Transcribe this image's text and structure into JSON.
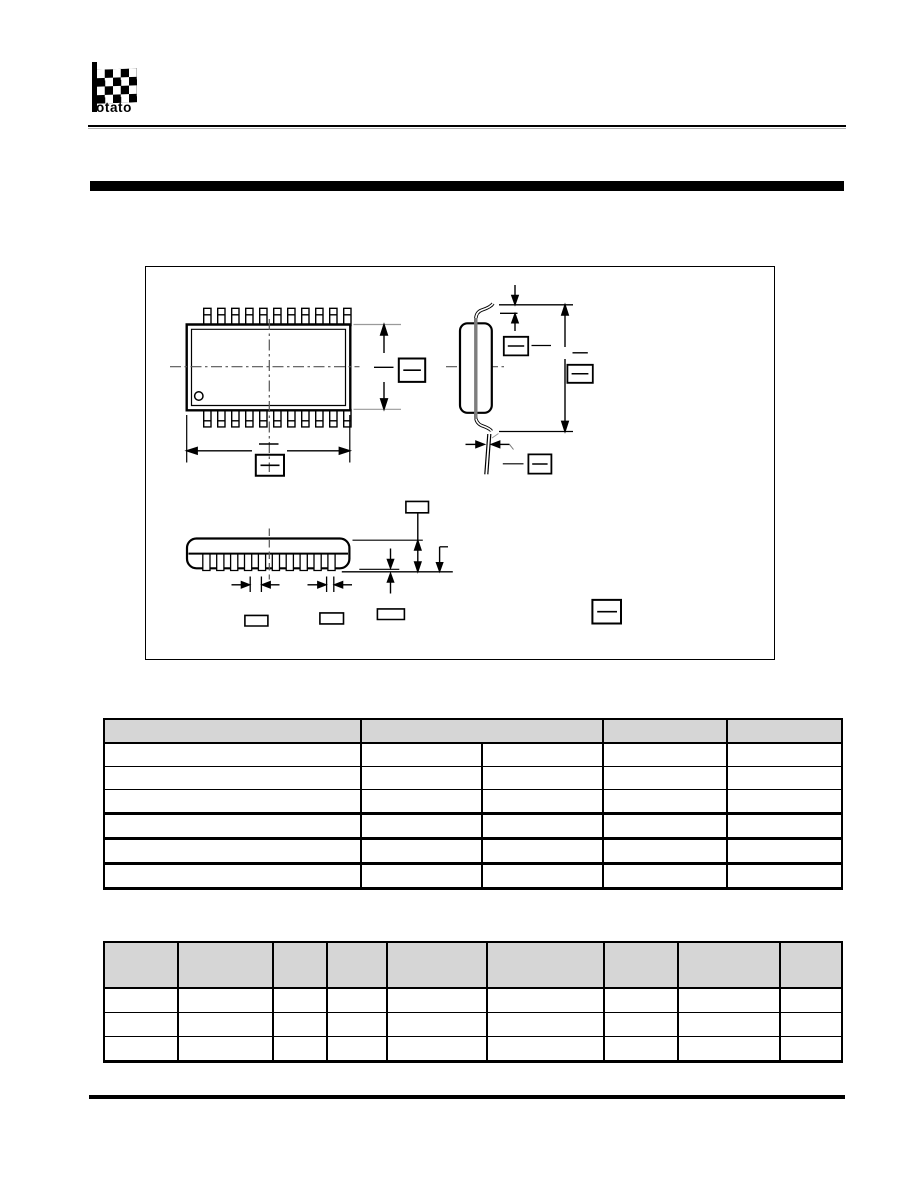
{
  "logo": {
    "brand_suffix": "otato",
    "flag_icon": "checkered-flag",
    "color": "#000000"
  },
  "rules": {
    "color": "#000000",
    "shadow_color": "#b3b3b3"
  },
  "section_bar": {
    "color": "#000000"
  },
  "drawing": {
    "description": "IC package outline drawing (SSOP type): top view, end view and side view with blank dimension callout boxes",
    "views": [
      "top-view",
      "end-view",
      "side-view"
    ],
    "pins_per_side": 11,
    "callout_boxes_with_divider": 6,
    "callout_boxes_plain": 4,
    "colors": {
      "line": "#000000",
      "centerline": "#555555",
      "lead_frame_section": "#7d7d7d",
      "extension_line": "#9a9a9a"
    }
  },
  "table1": {
    "header_fill": "#d6d6d6",
    "header_cells": [
      "",
      "",
      "",
      ""
    ],
    "rows": [
      [
        "",
        "",
        "",
        "",
        ""
      ],
      [
        "",
        "",
        "",
        "",
        ""
      ],
      [
        "",
        "",
        "",
        "",
        ""
      ],
      [
        "",
        "",
        "",
        "",
        ""
      ],
      [
        "",
        "",
        "",
        "",
        ""
      ],
      [
        "",
        "",
        "",
        "",
        ""
      ]
    ]
  },
  "table2": {
    "header_fill": "#d6d6d6",
    "header_cells": [
      "",
      "",
      "",
      "",
      "",
      "",
      "",
      "",
      ""
    ],
    "rows": [
      [
        "",
        "",
        "",
        "",
        "",
        "",
        "",
        "",
        ""
      ],
      [
        "",
        "",
        "",
        "",
        "",
        "",
        "",
        "",
        ""
      ],
      [
        "",
        "",
        "",
        "",
        "",
        "",
        "",
        "",
        ""
      ]
    ]
  }
}
